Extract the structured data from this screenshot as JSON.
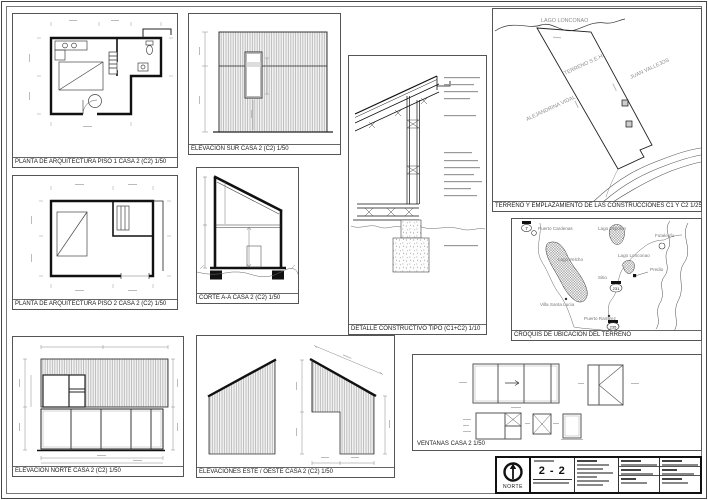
{
  "sheet": {
    "panels": {
      "planta1": {
        "title": "PLANTA DE ARQUITECTURA PISO 1 CASA 2 (C2) 1/50"
      },
      "elev_sur": {
        "title": "ELEVACION SUR CASA 2 (C2) 1/50"
      },
      "detalle": {
        "title": "DETALLE CONSTRUCTIVO TIPO (C1+C2) 1/10"
      },
      "terreno": {
        "title": "TERRENO Y EMPLAZAMIENTO DE LAS CONSTRUCCIONES C1 Y C2 1/2500",
        "labels": {
          "lago": "LAGO LONCONAO",
          "terreno": "TERRENO S.E.H.",
          "vecino_este": "JUAN VALLEJOS",
          "vecino_oeste": "ALEJANDRINA VIDAL"
        }
      },
      "croquis": {
        "title": "CROQUIS DE UBICACION DEL TERRENO",
        "labels": {
          "puerto_cardenas": "Puerto Cardenas",
          "lago_espolon": "Lago Espolon",
          "futaleufu": "Futaleufu",
          "lago_yelcho": "Lago Yelcho",
          "lago_lonconao": "Lago Lonconao",
          "predio": "Predio",
          "sitio": "Sitio",
          "villa_santa_lucia": "Villa Santa Lucia",
          "puerto_ramirez": "Puerto Ramirez",
          "ruta7": "7",
          "ruta231": "231",
          "ruta235": "235"
        }
      },
      "planta2": {
        "title": "PLANTA DE ARQUITECTURA PISO 2 CASA 2 (C2) 1/50"
      },
      "corte": {
        "title": "CORTE A-A CASA 2 (C2) 1/50"
      },
      "elev_norte": {
        "title": "ELEVACION NORTE CASA 2 (C2) 1/50"
      },
      "elev_este_oeste": {
        "title": "ELEVACIONES ESTE / OESTE CASA 2 (C2) 1/50"
      },
      "ventanas": {
        "title": "VENTANAS CASA 2 1/50"
      }
    },
    "titleblock": {
      "sheet_number": "2 - 2",
      "north_label": "NORTE"
    },
    "colors": {
      "ink": "#1a1a1a",
      "hatch": "#9a9a9a",
      "label_gray": "#8c8c8c",
      "paper": "#ffffff"
    }
  }
}
